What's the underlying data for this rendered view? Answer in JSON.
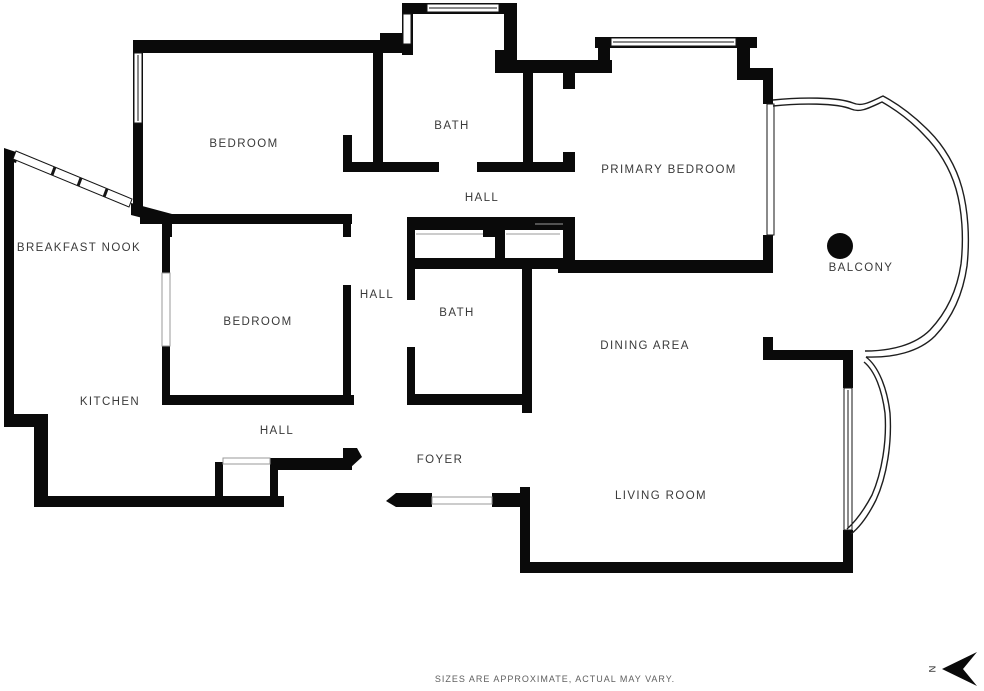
{
  "rooms": {
    "bedroom_nw": "BEDROOM",
    "bath_top": "BATH",
    "primary_bedroom": "PRIMARY BEDROOM",
    "hall_upper": "HALL",
    "breakfast_nook": "BREAKFAST NOOK",
    "balcony": "BALCONY",
    "hall_mid": "HALL",
    "bedroom_mid": "BEDROOM",
    "bath_mid": "BATH",
    "dining_area": "DINING AREA",
    "kitchen": "KITCHEN",
    "hall_lower": "HALL",
    "foyer": "FOYER",
    "living_room": "LIVING ROOM"
  },
  "footer": {
    "disclaimer": "SIZES ARE APPROXIMATE, ACTUAL MAY VARY."
  },
  "compass": {
    "north_label": "N"
  },
  "colors": {
    "wall": "#0a0a0a",
    "label": "#3a3a3a",
    "footer_text": "#5f5f5f",
    "window_stroke": "#161616",
    "faint_stroke": "#9a9a9a",
    "background": "#ffffff"
  }
}
